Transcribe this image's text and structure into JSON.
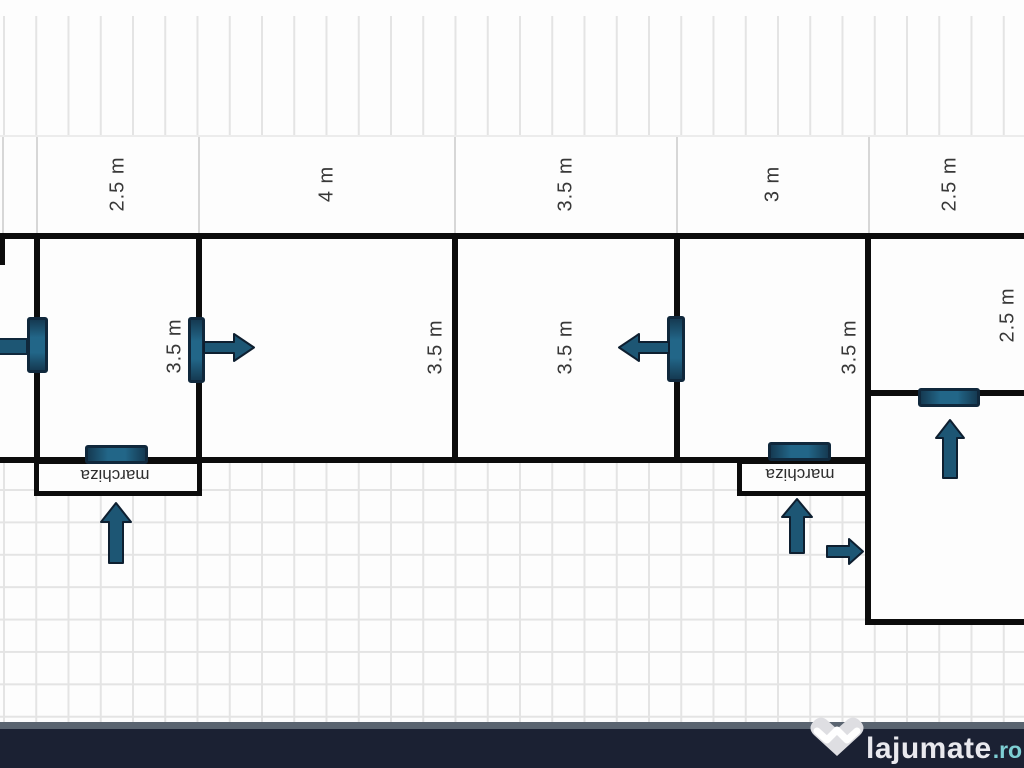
{
  "floor_plan": {
    "top_dimensions": [
      "2.5 m",
      "4 m",
      "3.5 m",
      "3 m",
      "2.5 m"
    ],
    "room_depths": [
      "3.5 m",
      "3.5 m",
      "3.5 m",
      "3.5 m",
      "2.5 m"
    ],
    "annex_labels": [
      "marchiza",
      "marchiza"
    ]
  },
  "watermark": {
    "brand": "lajumate",
    "tld": ".ro"
  },
  "colors": {
    "wall": "#0c0c0c",
    "door_fill": "#1d5674",
    "door_border": "#10283c",
    "top_bar": "#161c26",
    "bottom_bar": "#1b2133",
    "logo_text": "#e9e9ee",
    "logo_tld": "#7ecfd4",
    "grid_line": "#e4e4e4"
  }
}
